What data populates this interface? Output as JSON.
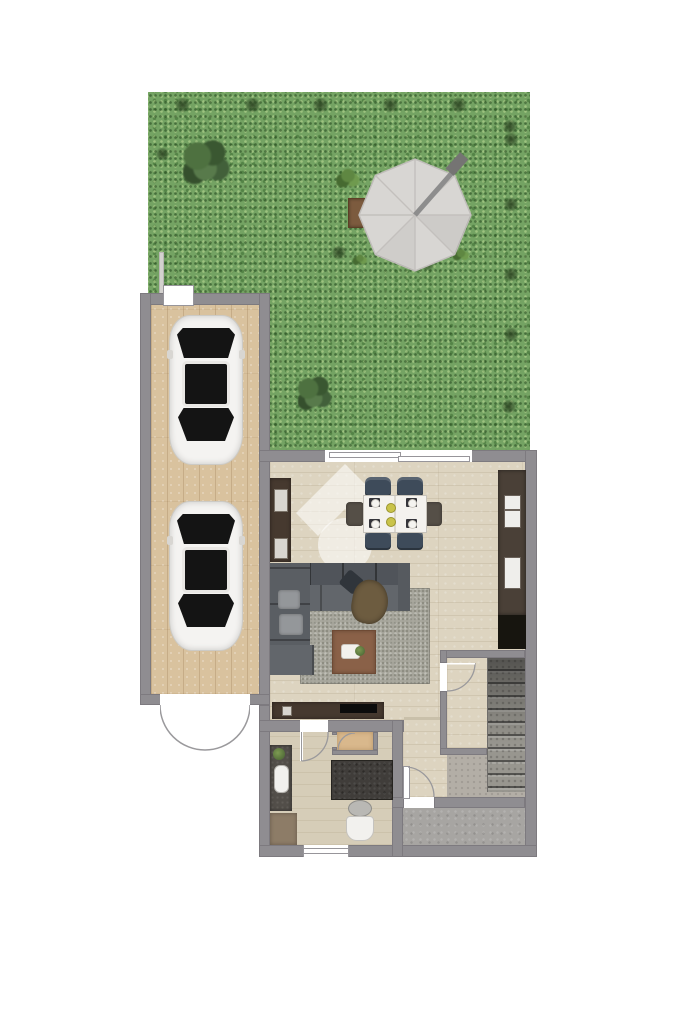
{
  "meta": {
    "kind": "2d-floor-plan-render",
    "description": "Top-down colored floor plan of a ground floor: garden with parasol, tandem double garage with two cars, open living/dining room with kitchen counter run, bathroom, small storage room, hallway with front door, under-stair closet, staircase and grey entry area",
    "visible_text": []
  },
  "colors": {
    "page_bg": "#ffffff",
    "grass": "#74a363",
    "wall": "#8f8d91",
    "wood_floor": "#ddd4c0",
    "garage_floor": "#d9c29e",
    "bath_floor": "#d6cdb8",
    "tan_floor": "#d9b88c",
    "entry_floor": "#a7a5a2",
    "stairs": "#98968f",
    "counter_dark": "#4a4037",
    "cabinet_brown": "#46392f",
    "sofa": "#565a5f",
    "sofa_light": "#62666b",
    "rug": "#a8a79d",
    "coffee_table": "#8a6148",
    "chair_navy": "#3e4b5a",
    "chair_taupe": "#554f47",
    "car_body": "#f4f3f1",
    "car_glass": "#141414",
    "parasol": "#d8d6d3",
    "planter": "#7c5b3e",
    "vanity": "#524e49",
    "shower": "#403d3a",
    "bathmat": "#8d7c67",
    "throw": "#6d5c40",
    "watermark": "rgba(255,255,255,0.55)"
  },
  "areas": [
    {
      "id": "garden",
      "label": "garden lawn",
      "features": [
        "octagonal parasol with pole",
        "5 hedge squares top row",
        "5 hedge squares right edge",
        "large shrub",
        "fern",
        "wooden planter",
        "shrub near house"
      ]
    },
    {
      "id": "garage",
      "label": "tandem garage",
      "features": [
        "two white cars parked in line",
        "garden door at top",
        "double swing door at bottom"
      ]
    },
    {
      "id": "living_dining",
      "label": "open living / dining room",
      "features": [
        "sliding glass door to garden",
        "dining table with 6 chairs and place settings",
        "dark kitchen counter run with sink and hob",
        "black fridge",
        "sideboard",
        "corner sofa",
        "area rug",
        "coffee table with tray and plant",
        "tv sideboard"
      ]
    },
    {
      "id": "bathroom",
      "label": "bathroom",
      "features": [
        "vanity with sink and plant",
        "walk-in shower",
        "toilet",
        "bath mat",
        "window in bottom wall"
      ]
    },
    {
      "id": "storage_room",
      "label": "small storage room with tan floor"
    },
    {
      "id": "hallway",
      "label": "hallway",
      "features": [
        "front door with swing arc"
      ]
    },
    {
      "id": "closet",
      "label": "under-stair closet with door"
    },
    {
      "id": "stairs",
      "label": "staircase going down",
      "steps": 10
    },
    {
      "id": "entry",
      "label": "grey entry area"
    }
  ],
  "counts": {
    "cars": 2,
    "dining_chairs": 6,
    "parasols": 1,
    "door_swings": 6
  },
  "watermark": {
    "name": "house-logo-watermark",
    "shape": "roof chevron above circle",
    "style": "semi-transparent white"
  }
}
